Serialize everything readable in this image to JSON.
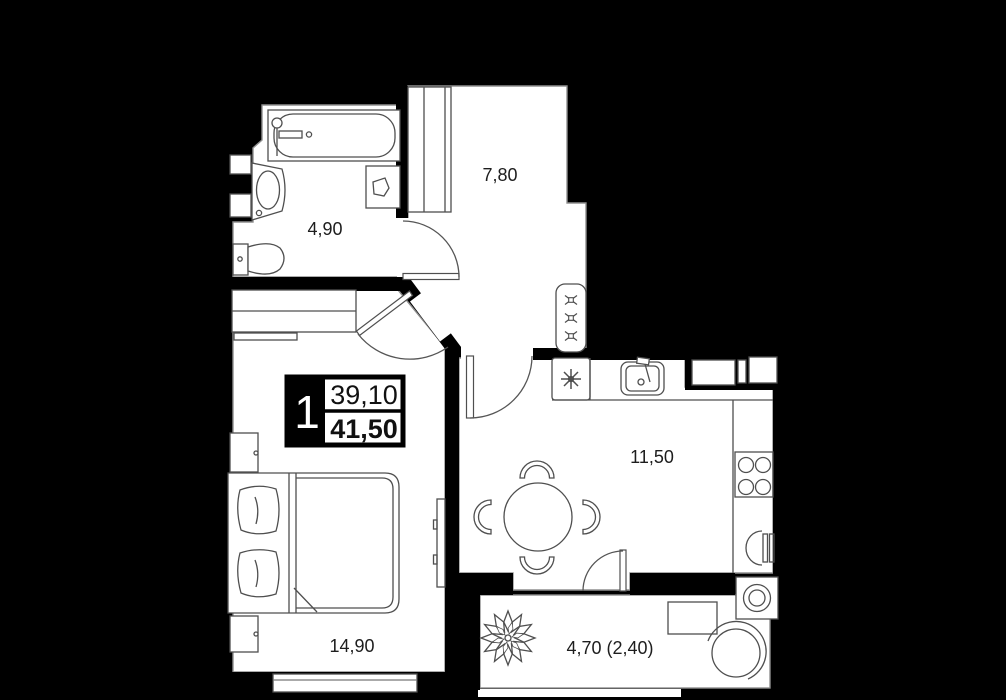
{
  "plan": {
    "badge": {
      "rooms_count": "1",
      "living_area": "39,10",
      "total_area": "41,50"
    },
    "rooms": [
      {
        "id": "bathroom",
        "area_label": "4,90"
      },
      {
        "id": "hallway",
        "area_label": "7,80"
      },
      {
        "id": "kitchen",
        "area_label": "11,50"
      },
      {
        "id": "bedroom",
        "area_label": "14,90"
      },
      {
        "id": "balcony",
        "area_label": "4,70 (2,40)"
      }
    ],
    "colors": {
      "background": "#000000",
      "floor": "#ffffff",
      "wall": "#000000",
      "furniture_line": "#4f4f4f",
      "label_text": "#1d1d1d"
    }
  }
}
